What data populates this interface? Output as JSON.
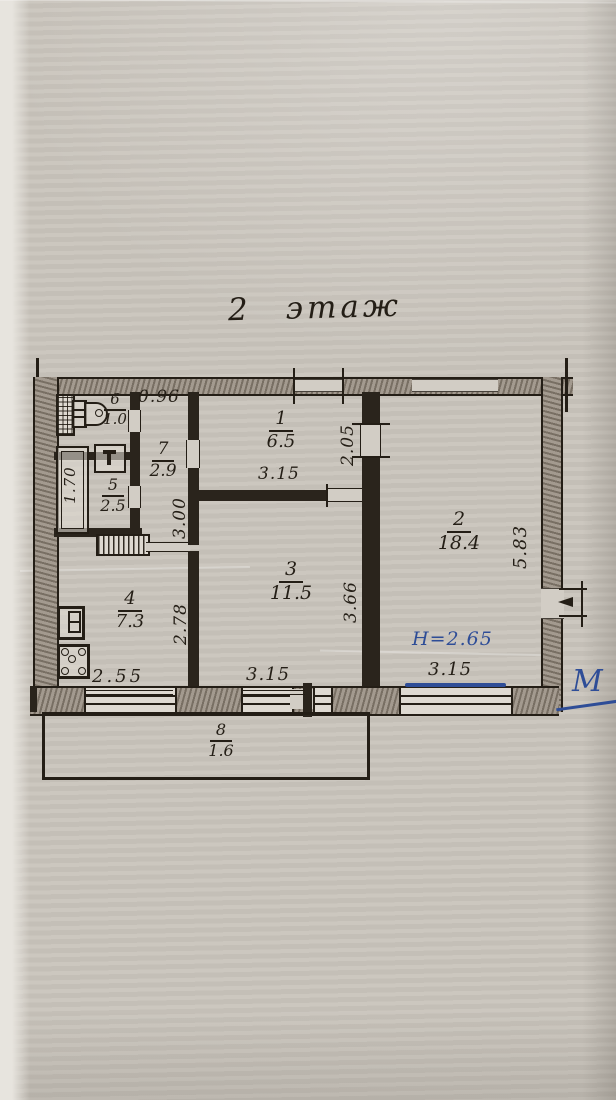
{
  "title": {
    "floor_label": "2 этаж"
  },
  "rooms": {
    "r1": {
      "number": "1",
      "area": "6.5"
    },
    "r2": {
      "number": "2",
      "area": "18.4"
    },
    "r3": {
      "number": "3",
      "area": "11.5"
    },
    "r4": {
      "number": "4",
      "area": "7.3"
    },
    "r5": {
      "number": "5",
      "area": "2.5"
    },
    "r6": {
      "number": "6",
      "area": "1.0"
    },
    "r7": {
      "number": "7",
      "area": "2.9"
    },
    "r8": {
      "number": "8",
      "area": "1.6"
    }
  },
  "dims": {
    "corridor_width": "0.96",
    "room1_depth": "2.05",
    "room1_width": "3.15",
    "corridor_length": "3.00",
    "bathtub_length": "1.70",
    "kitchen_depth": "2.78",
    "room3_depth": "3.66",
    "room2_depth": "5.83",
    "kitchen_window_width": "2.55",
    "room3_window_width": "3.15",
    "room2_window_width": "3.15"
  },
  "notes": {
    "ceiling_height": "Н=2.65",
    "margin_mark": "М"
  },
  "colors": {
    "ink": "#241e16",
    "blue_ink": "#2e4d97",
    "paper": "#c9c4bc"
  }
}
